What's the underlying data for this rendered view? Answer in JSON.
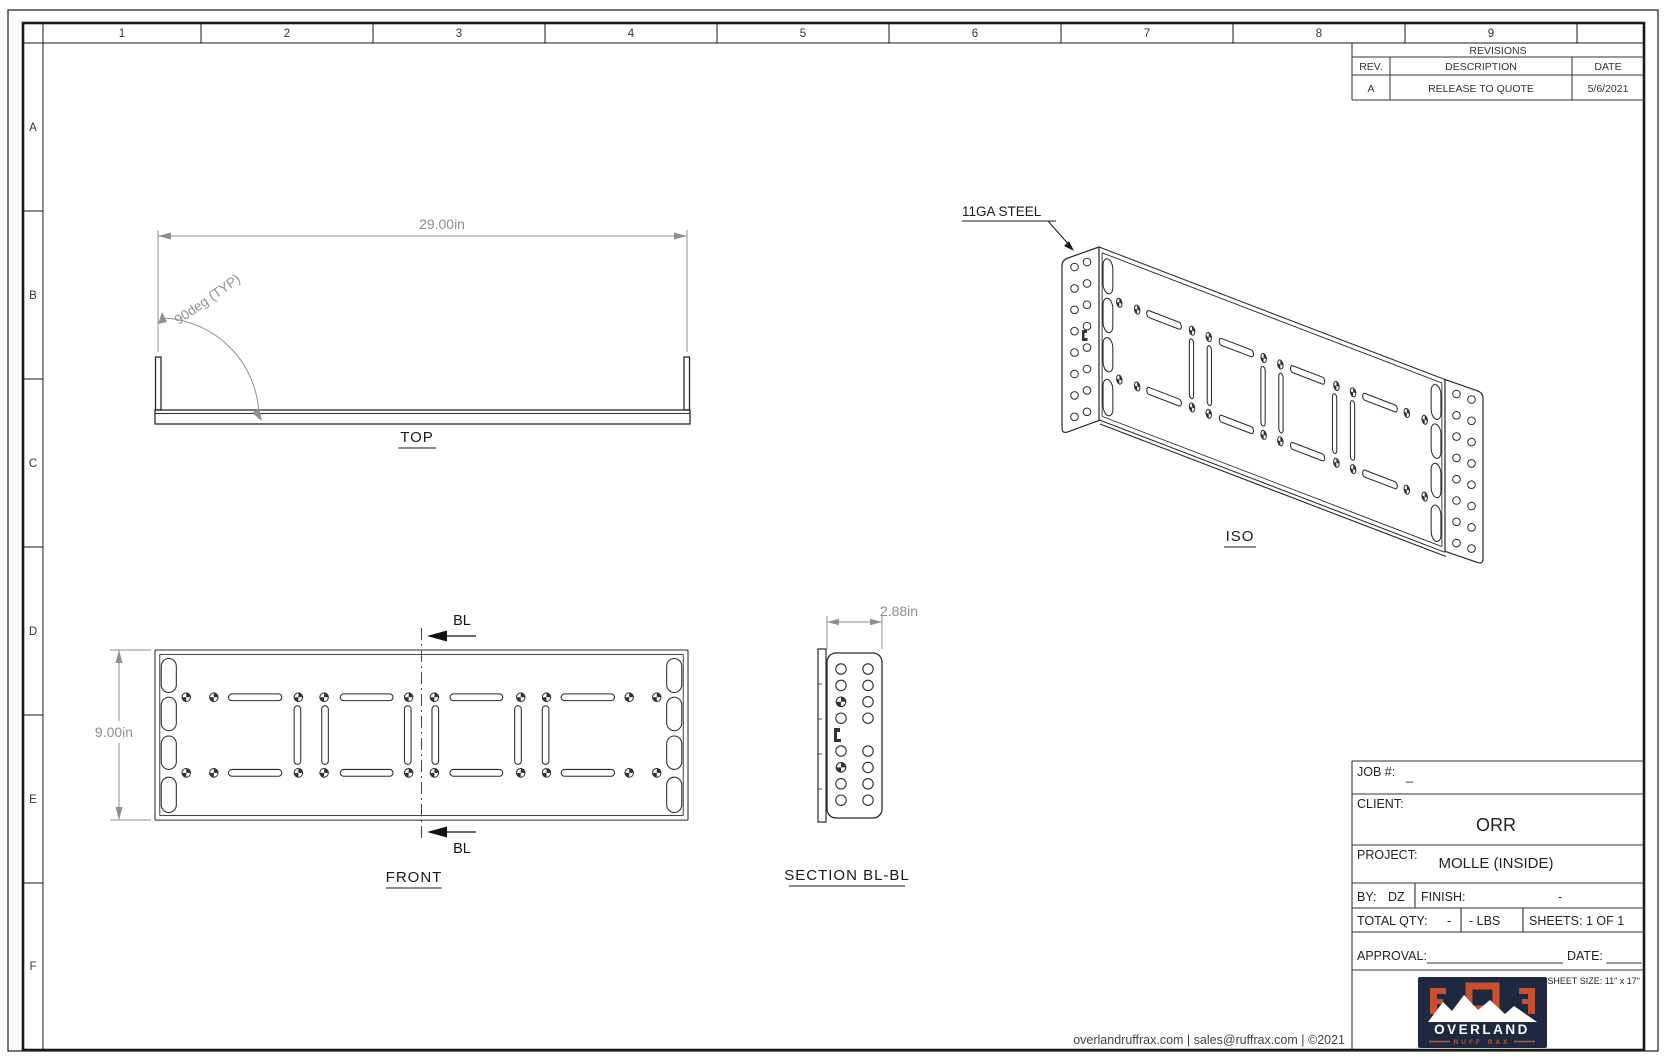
{
  "sheet_border": {
    "columns": [
      "1",
      "2",
      "3",
      "4",
      "5",
      "6",
      "7",
      "8",
      "9"
    ],
    "rows": [
      "A",
      "B",
      "C",
      "D",
      "E",
      "F"
    ]
  },
  "revisions_table": {
    "title": "REVISIONS",
    "col_rev": "REV.",
    "col_desc": "DESCRIPTION",
    "col_date": "DATE",
    "row_rev": "A",
    "row_desc": "RELEASE TO QUOTE",
    "row_date": "5/6/2021"
  },
  "views": {
    "top_label": "TOP",
    "front_label": "FRONT",
    "iso_label": "ISO",
    "section_label": "SECTION BL-BL",
    "dim_length": "29.00in",
    "dim_angle": "90deg (TYP)",
    "dim_height": "9.00in",
    "dim_depth": "2.88in",
    "material_note": "11GA STEEL",
    "section_marker_top": "BL",
    "section_marker_bottom": "BL"
  },
  "title_block": {
    "job_label": "JOB #:",
    "job_value": "_",
    "client_label": "CLIENT:",
    "client_value": "ORR",
    "project_label": "PROJECT:",
    "project_value": "MOLLE (INSIDE)",
    "by_label": "BY:",
    "by_value": "DZ",
    "finish_label": "FINISH:",
    "finish_value": "-",
    "qty_label": "TOTAL QTY:",
    "qty_value": "-",
    "weight_value": "- LBS",
    "sheets_value": "SHEETS: 1 OF 1",
    "approval_label": "APPROVAL:",
    "date_label": "DATE:",
    "sheet_size": "SHEET SIZE: 11\" x 17\""
  },
  "logo": {
    "brand": "OVERLAND",
    "sub_brand": "RUFF RAX"
  },
  "footer": {
    "contact": "overlandruffrax.com |  sales@ruffrax.com  |  ©2021"
  },
  "colors": {
    "line": "#2b2b2b",
    "dim": "#8f8f8f",
    "navy": "#1e2940",
    "orange": "#c9502e"
  }
}
